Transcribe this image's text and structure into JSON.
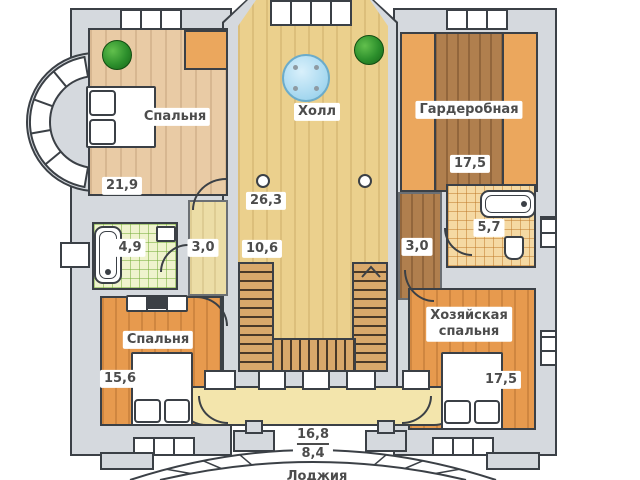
{
  "drawing_type": "apartment-floor-plan",
  "language": "ru",
  "rooms": {
    "bedroom1": {
      "label": "Спальня",
      "area": "21,9"
    },
    "hall": {
      "label": "Холл",
      "area": "26,3"
    },
    "wardrobe": {
      "label": "Гардеробная",
      "area": "17,5"
    },
    "bath_left": {
      "area": "4,9"
    },
    "corridor_left": {
      "area": "3,0"
    },
    "stairs": {
      "area": "10,6"
    },
    "corridor_right": {
      "area": "3,0"
    },
    "bath_right": {
      "area": "5,7"
    },
    "bedroom2": {
      "label": "Спальня",
      "area": "15,6"
    },
    "master": {
      "label_line1": "Хозяйская",
      "label_line2": "спальня",
      "area": "17,5"
    },
    "loggia": {
      "label": "Лоджия",
      "area_total": "16,8",
      "area_usable": "8,4"
    }
  },
  "colors": {
    "wall_fill": "#d5d9de",
    "outline": "#3b4046",
    "hall_floor": "#ebd08d",
    "light_wood_floor": "#e9cba5",
    "orange_wood_floor": "#e79a4e",
    "dark_wood_floor": "#b07f4e",
    "cabinet_orange": "#eba75d",
    "tile_green": "#eff3cd",
    "tile_orange": "#f5d9a3",
    "loggia_floor": "#f3e5ac",
    "stair_tread": "#d9a96b",
    "table_blue": "#a0d5ee",
    "plant_green": "#2c8f2c"
  }
}
